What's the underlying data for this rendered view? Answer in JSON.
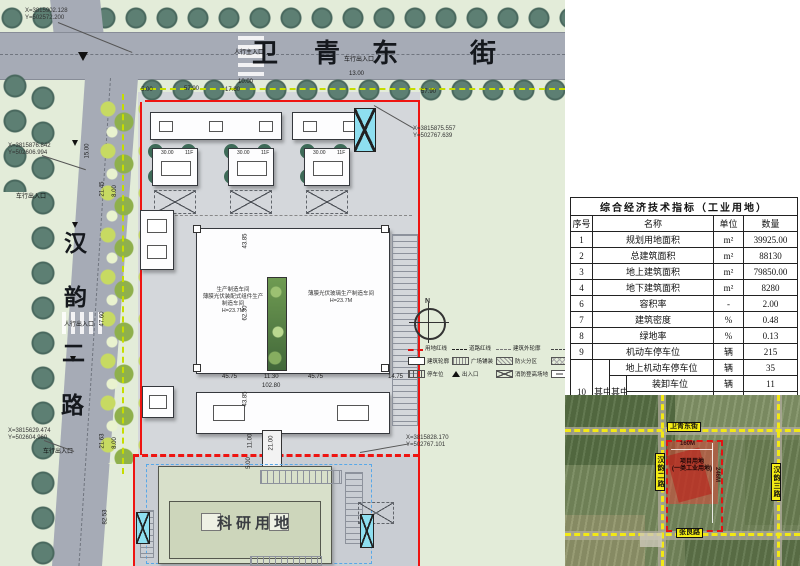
{
  "plan": {
    "north_street_chars": [
      "卫",
      "青",
      "东",
      "街"
    ],
    "west_street_chars": [
      "汉",
      "韵",
      "二",
      "路"
    ],
    "entrances": {
      "top_ped": "人行主入口",
      "top_veh": "车行出入口",
      "west_veh_n": "车行出入口",
      "west_ped": "人行出入口",
      "west_veh_s": "车行出入口"
    },
    "coords": [
      {
        "x": "X=3815902.128",
        "y": "Y=502572.200"
      },
      {
        "x": "X=3815876.842",
        "y": "Y=502606.994"
      },
      {
        "x": "X=3815629.474",
        "y": "Y=502604.960"
      },
      {
        "x": "X=3815875.557",
        "y": "Y=502767.639"
      },
      {
        "x": "X=3815828.170",
        "y": "Y=502767.101"
      }
    ],
    "dims": [
      "10.00",
      "13.00",
      "17.80",
      "57.90",
      "5.00",
      "57.90",
      "15.00",
      "21.45",
      "8.00",
      "47.60",
      "21.63",
      "8.00",
      "82.53",
      "43.85",
      "62.30",
      "45.75",
      "11.30",
      "45.75",
      "102.80",
      "14.75",
      "43.85",
      "11.00",
      "21.00",
      "5.00"
    ],
    "buildings": {
      "tower_dim": "30.00",
      "tower_floors": "11F",
      "workshop_left": [
        "生产制造车间",
        "薄膜光伏装配式组件生产制造车间",
        "H=23.7M"
      ],
      "workshop_right": [
        "薄膜光伏玻璃生产制造车间",
        "H=23.7M"
      ],
      "research_label": "科研用地"
    },
    "compass": "N",
    "legend": [
      "用地红线",
      "道路红线",
      "建筑外轮廓",
      "地库轮廓线",
      "建筑轮廓",
      "广场铺装",
      "防火分区",
      "绿化种植",
      "停车位",
      "出入口",
      "消防登高场地",
      "装卸车位"
    ]
  },
  "table": {
    "title": "综合经济技术指标（工业用地）",
    "headers": {
      "no": "序号",
      "name": "名称",
      "unit": "单位",
      "qty": "数量"
    },
    "rows": [
      {
        "no": "1",
        "name": "规划用地面积",
        "unit": "m²",
        "qty": "39925.00"
      },
      {
        "no": "2",
        "name": "总建筑面积",
        "unit": "m²",
        "qty": "88130"
      },
      {
        "no": "3",
        "name": "地上建筑面积",
        "unit": "m²",
        "qty": "79850.00"
      },
      {
        "no": "4",
        "name": "地下建筑面积",
        "unit": "m²",
        "qty": "8280"
      },
      {
        "no": "6",
        "name": "容积率",
        "unit": "-",
        "qty": "2.00"
      },
      {
        "no": "7",
        "name": "建筑密度",
        "unit": "%",
        "qty": "0.48"
      },
      {
        "no": "8",
        "name": "绿地率",
        "unit": "%",
        "qty": "0.13"
      },
      {
        "no": "9",
        "name": "机动车停车位",
        "unit": "辆",
        "qty": "215"
      }
    ],
    "group10": {
      "no": "10",
      "mid1": "其中",
      "mid2": "其中",
      "rows": [
        {
          "name": "地上机动车停车位",
          "unit": "辆",
          "qty": "35"
        },
        {
          "name": "装卸车位",
          "unit": "辆",
          "qty": "11"
        },
        {
          "name": "普通车位",
          "unit": "辆",
          "qty": "24"
        },
        {
          "name": "地下机动车停车位",
          "unit": "辆",
          "qty": "180"
        }
      ]
    },
    "row11": {
      "no": "11",
      "name": "非机动车位",
      "unit": "辆",
      "qty": "424"
    }
  },
  "satellite": {
    "road_top": "卫青东街",
    "road_bottom": "张良路",
    "road_left": "汉韵二路",
    "road_right": "汉韵三路",
    "dim_w": "160M",
    "dim_h": "246M",
    "site_line1": "项目用地",
    "site_line2": "(一类工业用地)"
  }
}
